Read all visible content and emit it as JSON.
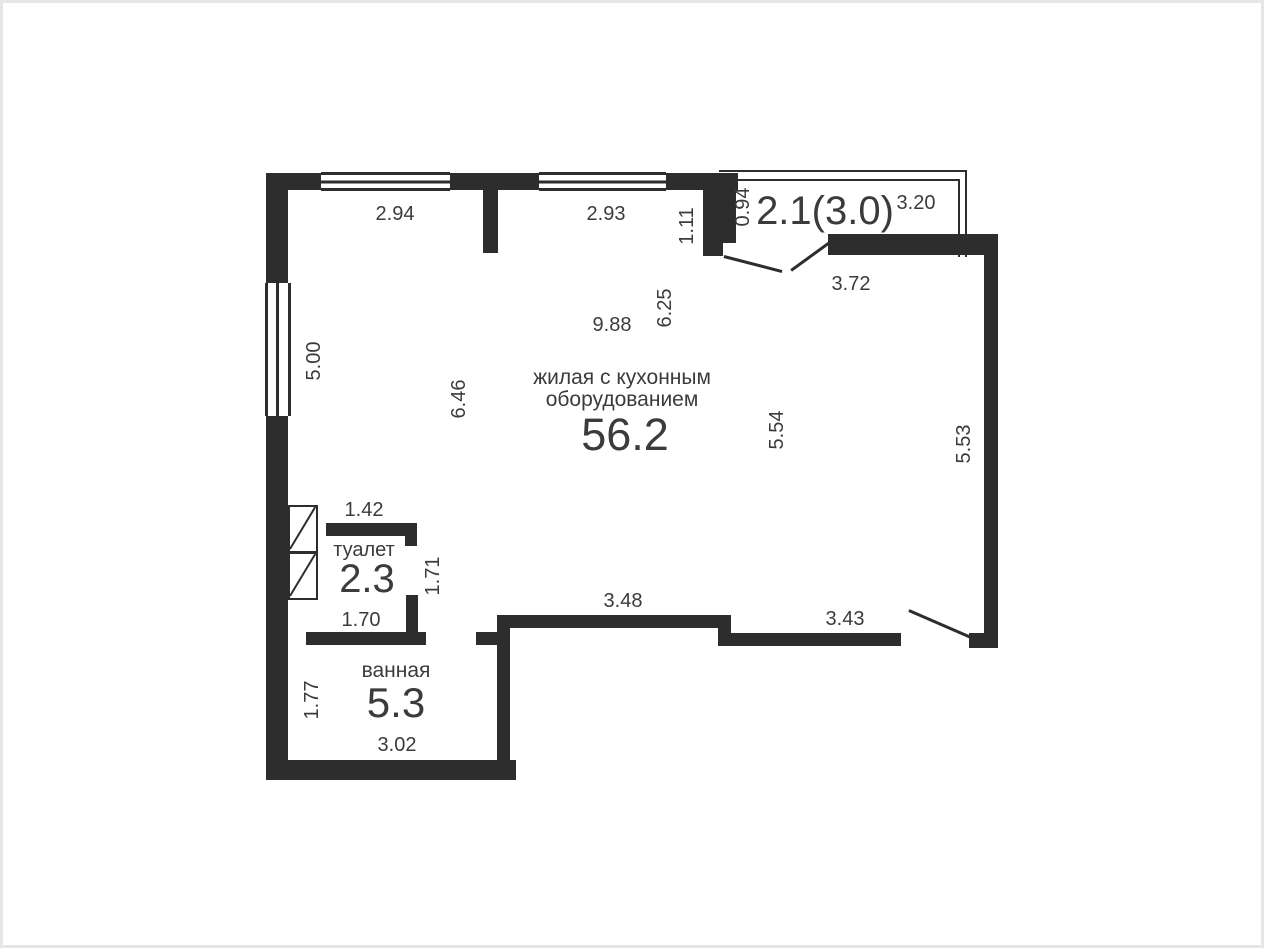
{
  "canvas": {
    "background": "#ffffff",
    "frame_color": "#e6e6e6",
    "wall_color": "#2d2d2d",
    "text_color": "#3b3b3b"
  },
  "rooms": {
    "living": {
      "name_line1": "жилая с кухонным",
      "name_line2": "оборудованием",
      "area": "56.2"
    },
    "toilet": {
      "name": "туалет",
      "area": "2.3"
    },
    "bathroom": {
      "name": "ванная",
      "area": "5.3"
    },
    "balcony": {
      "area": "2.1(3.0)"
    }
  },
  "dimensions": [
    {
      "value": "2.94"
    },
    {
      "value": "2.93"
    },
    {
      "value": "1.11"
    },
    {
      "value": "0.94"
    },
    {
      "value": "3.20"
    },
    {
      "value": "3.72"
    },
    {
      "value": "5.00"
    },
    {
      "value": "9.88"
    },
    {
      "value": "6.25"
    },
    {
      "value": "6.46"
    },
    {
      "value": "5.54"
    },
    {
      "value": "5.53"
    },
    {
      "value": "1.42"
    },
    {
      "value": "1.71"
    },
    {
      "value": "1.70"
    },
    {
      "value": "3.48"
    },
    {
      "value": "3.43"
    },
    {
      "value": "1.77"
    },
    {
      "value": "3.02"
    }
  ]
}
